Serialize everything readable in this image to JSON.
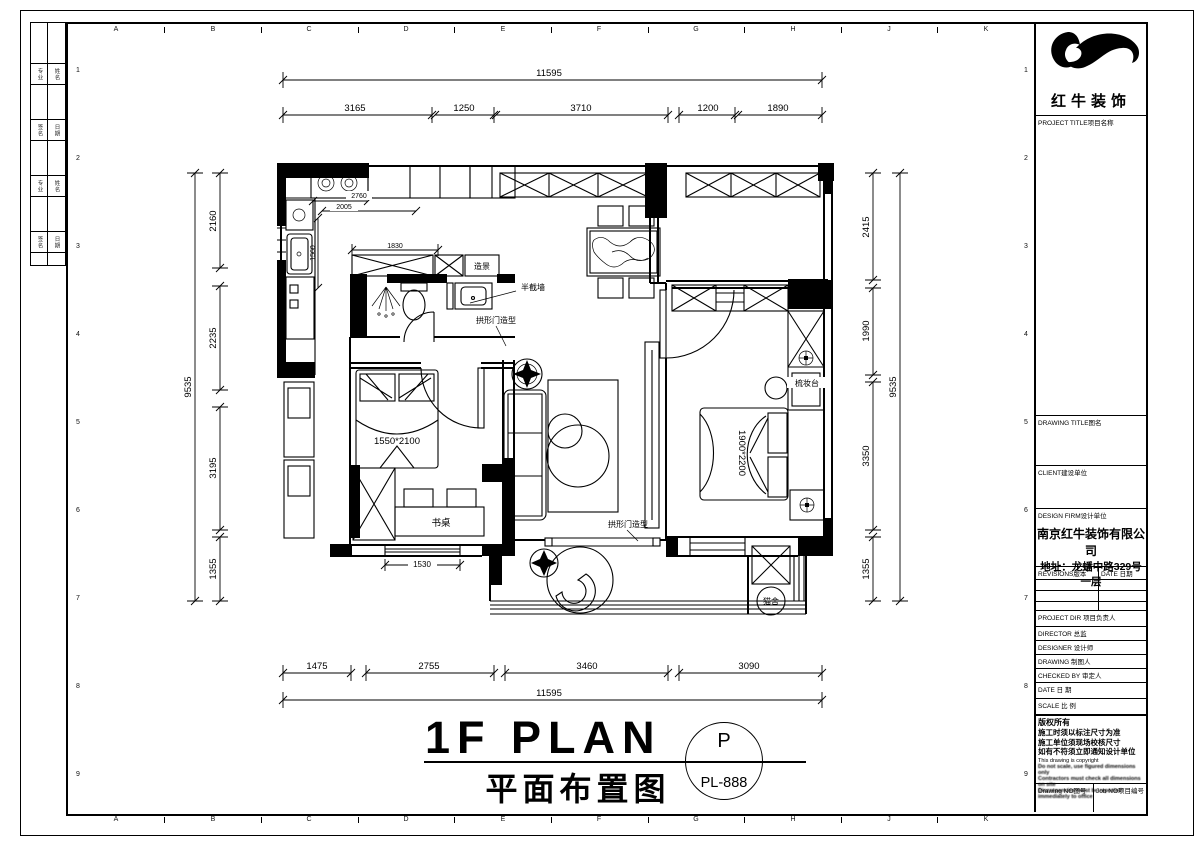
{
  "sheet": {
    "grid_letters": [
      "A",
      "B",
      "C",
      "D",
      "E",
      "F",
      "G",
      "H",
      "J",
      "K"
    ],
    "row_numbers": [
      "1",
      "2",
      "3",
      "4",
      "5",
      "6",
      "7",
      "8",
      "9"
    ],
    "signature_cells": [
      "专业",
      "姓名",
      "签名",
      "日期",
      "专业",
      "姓名",
      "签名",
      "日期"
    ]
  },
  "title_block": {
    "company_name": "红牛装饰",
    "project_title_label": "PROJECT TITLE项目名称",
    "drawing_title_label": "DRAWING TITLE图名",
    "client_label": "CLIENT建设单位",
    "design_firm_label": "DESIGN FIRM设计单位",
    "design_firm_name": "南京红牛装饰有限公司",
    "design_firm_address": "地址：龙蟠中路329号一层",
    "revisions_label": "REVISIONS版本",
    "revisions_date_label": "DATE 日期",
    "project_director_label": "PROJECT DIR 项目负责人",
    "director_label": "DIRECTOR 总监",
    "designer_label": "DESIGNER    设计师",
    "drawing_by_label": "DRAWING    制图人",
    "checked_by_label": "CHECKED BY 审定人",
    "date_label": "DATE       日 期",
    "scale_label": "SCALE      比 例",
    "copyright_title": "版权所有",
    "copyright_line1": "施工时须以标注尺寸为准",
    "copyright_line2": "施工单位须现场校核尺寸",
    "copyright_line3": "如有不符须立即通知设计单位",
    "copyright_en_title": "This drawing is copyright",
    "copyright_en_line1": "Do not scale, use figured dimensions only",
    "copyright_en_line2": "Contractors must check all dimensions on site",
    "copyright_en_line3": "Discrepancies must be reported immediately to office",
    "drawing_no_label": "Drawing NO图号",
    "job_no_label": "Job NO项目编号"
  },
  "plan": {
    "labels": {
      "zaojing": "造景",
      "banjieqiang": "半截墙",
      "gongxingmen1": "拱形门造型",
      "gongxingmen2": "拱形门造型",
      "shuzhuo": "书桌",
      "shuzhuangtai": "梳妆台",
      "maoshe": "猫舍",
      "bed_small": "1550*2100",
      "bed_master": "1900*2200"
    },
    "dims": {
      "top_total": "11595",
      "top_segments": [
        "3165",
        "1250",
        "3710",
        "1200",
        "1890"
      ],
      "bottom_segments": [
        "1475",
        "2755",
        "3460",
        "3090"
      ],
      "bottom_total": "11595",
      "left_total": "9535",
      "left_segments": [
        "2160",
        "2235",
        "3195",
        "1355"
      ],
      "right_segments": [
        "2415",
        "1990",
        "3350",
        "1355"
      ],
      "right_total": "9535",
      "stove": "2760",
      "counter": "2005",
      "kitchen_depth": "1560",
      "bath_width": "1830",
      "bedroom_window": "1530"
    }
  },
  "footer": {
    "title_en": "1F PLAN",
    "title_cn": "平面布置图",
    "badge_letter": "P",
    "badge_code": "PL-888"
  }
}
